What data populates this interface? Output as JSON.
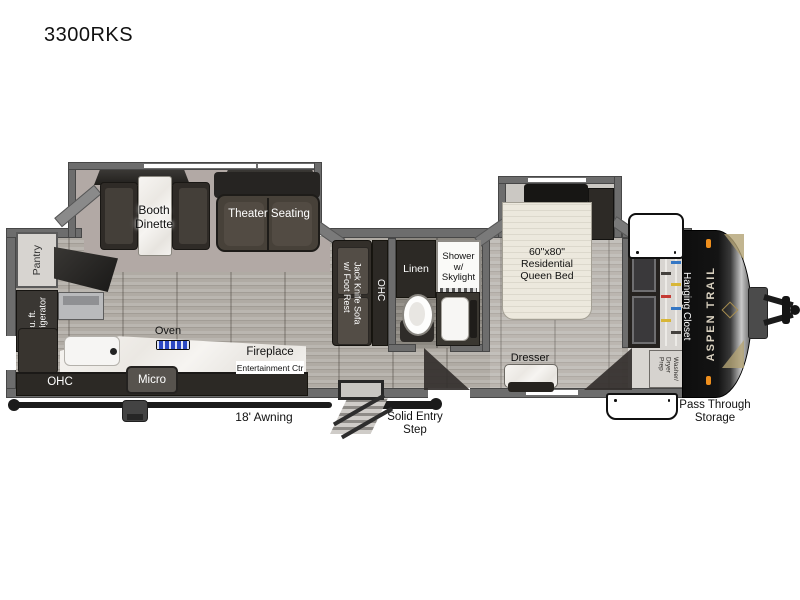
{
  "title": "3300RKS",
  "brand": "ASPEN TRAIL",
  "rear_kitchen": {
    "pantry": "Pantry",
    "refrigerator": "10 cu. ft.\nRefrigerator",
    "ohc": "OHC",
    "oven": "Oven",
    "micro": "Micro",
    "fireplace": "Fireplace",
    "entertainment_center": "Entertainment Ctr"
  },
  "living_area": {
    "booth_dinette": "Booth\nDinette",
    "theater_seating": "Theater Seating",
    "jack_knife_sofa": "Jack Knife Sofa\nw/ Foot Rest",
    "ohc": "OHC"
  },
  "bathroom": {
    "linen": "Linen",
    "shower": "Shower\nw/\nSkylight"
  },
  "bedroom": {
    "queen_bed": "60\"x80\"\nResidential\nQueen Bed",
    "dresser": "Dresser",
    "hanging_closet": "Hanging Closet",
    "washer_dryer_prep": "Washer/\nDryer\nPrep"
  },
  "exterior": {
    "awning": "18' Awning",
    "entry_step": "Solid Entry\nStep",
    "pass_through_storage": "Pass Through\nStorage"
  },
  "colors": {
    "wall_gray": "#6d6d6d",
    "floor_wood": "#b4b0aa",
    "carpet": "#b2a9a5",
    "cabinet_dark": "#2c2925",
    "counter_marble": "#f3f1ee",
    "cooktop_blue": "#2b49c4",
    "front_cap_black": "#0e0e0e",
    "brand_gold": "#b3a274",
    "marker_light_orange": "#ef8f1d",
    "hanger_red": "#c53a33",
    "hanger_blue": "#3577c4",
    "hanger_yellow": "#d8b637"
  }
}
